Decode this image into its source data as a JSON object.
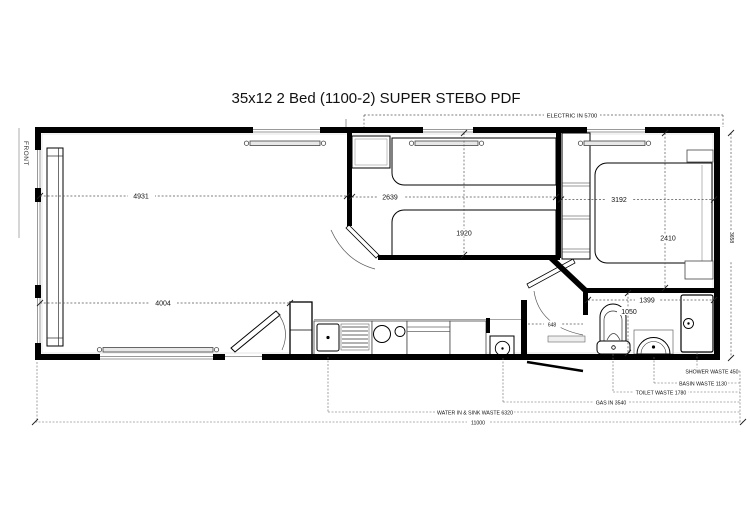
{
  "title": "35x12 2 Bed  (1100-2) SUPER  STEBO PDF",
  "orientation_label": "FRONT",
  "dimensions": {
    "lounge_length": "4931",
    "lounge_length_lower": "4004",
    "bedroom1_length": "2639",
    "bedroom1_width": "1920",
    "bedroom2_length": "3192",
    "bedroom2_width": "2410",
    "bathroom_length": "1399",
    "bathroom_width": "1050",
    "hallway": "648",
    "overall_width": "3658",
    "overall_length": "11000"
  },
  "services": {
    "electric_in": "ELECTRIC IN 5700",
    "water_in_sink_waste": "WATER IN & SINK WASTE 6320",
    "gas_in": "GAS IN 3540",
    "toilet_waste": "TOILET WASTE 1780",
    "basin_waste": "BASIN WASTE 1130",
    "shower_waste": "SHOWER WASTE 450"
  },
  "colors": {
    "wall": "#000000",
    "dim_line": "#555555",
    "glass": "#999999",
    "background": "#ffffff"
  }
}
